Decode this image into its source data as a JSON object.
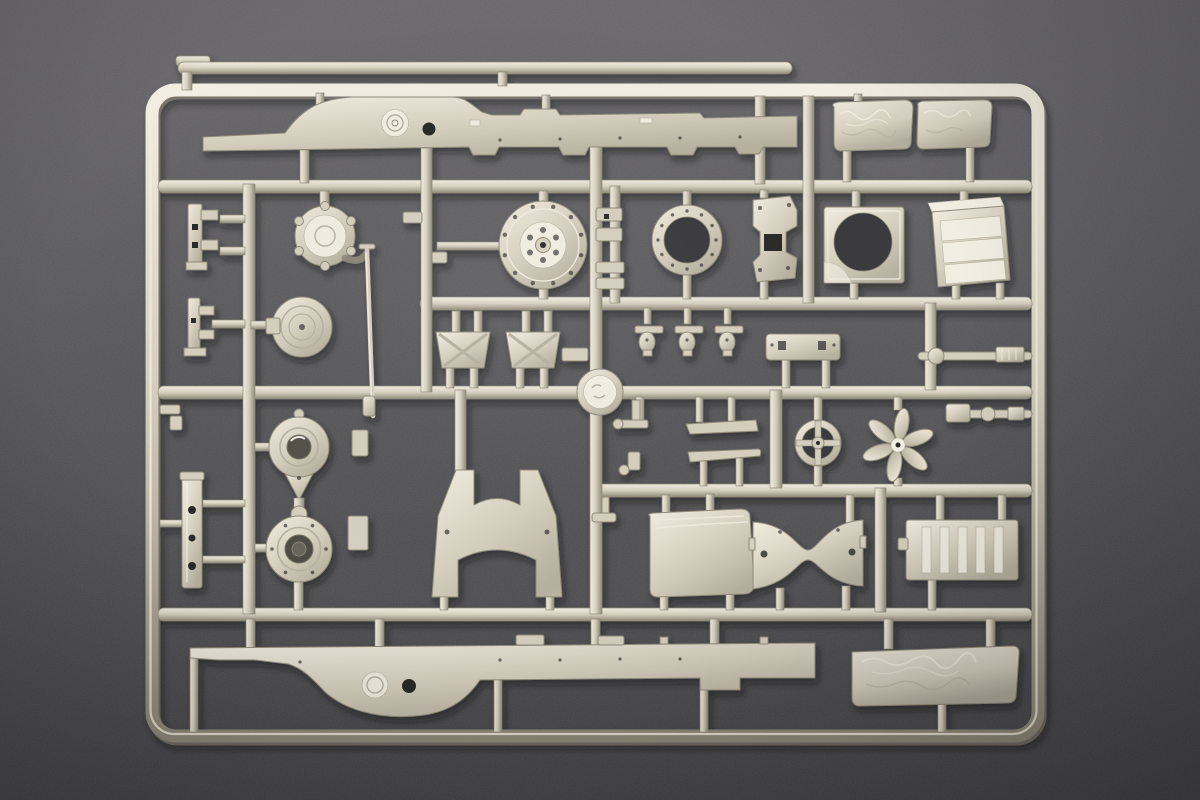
{
  "scene": {
    "type": "photograph",
    "subject": "Injection-moulded plastic model-kit sprue (parts tree) of light grey-beige styrene lying on a dark grey textured surface",
    "lighting": "soft light from upper left, parts cast small soft shadows",
    "text_visible": "none"
  },
  "colors": {
    "bg_top": "#615f63",
    "bg_mid": "#4c4b4e",
    "bg_bottom": "#39383b",
    "bg_hole": "#3b3a3d",
    "plastic_light": "#f2eee1",
    "plastic_base": "#d6d0bf",
    "plastic_mid": "#b7b1a0",
    "plastic_dark": "#918b7b",
    "hole_dark": "#2b2a28",
    "canvas_light": "#ece8dc",
    "canvas_shade": "#b3ad9d"
  },
  "sprue": {
    "frame": "rectangular outer runner frame with rounded corners, five internal horizontal runners and many vertical feed runners",
    "parts": [
      {
        "name": "top-runner-bar",
        "desc": "spare thin runner bar above the top rail"
      },
      {
        "name": "chassis-rail-top",
        "desc": "long ladder-chassis side rail with raised hump, round boss and open hole"
      },
      {
        "name": "canvas-tilt-left",
        "desc": "crumpled canvas tilt block"
      },
      {
        "name": "canvas-tilt-right",
        "desc": "crumpled canvas tilt block"
      },
      {
        "name": "filler-pot",
        "desc": "round filler pot with spout"
      },
      {
        "name": "torsion-rod",
        "desc": "long thin rod with collar"
      },
      {
        "name": "pot-lid",
        "desc": "round lid with concentric rings"
      },
      {
        "name": "axle-gear-disc",
        "desc": "large bolted hub disc with centre bore"
      },
      {
        "name": "turret-ring",
        "desc": "large open bolt ring"
      },
      {
        "name": "cab-bracket",
        "desc": "angled bracket plate with square opening"
      },
      {
        "name": "hatch-frame",
        "desc": "square frame with large round opening"
      },
      {
        "name": "radiator-box",
        "desc": "louvred radiator box seen in perspective"
      },
      {
        "name": "spring-clip-a",
        "desc": "small stepped clip on left edge"
      },
      {
        "name": "spring-clip-b",
        "desc": "small stepped clip on left edge"
      },
      {
        "name": "clip-pair",
        "desc": "two small clips beside centre runner"
      },
      {
        "name": "x-brace-panel-left",
        "desc": "trapezoid panel with X bracing"
      },
      {
        "name": "x-brace-panel-right",
        "desc": "trapezoid panel with X bracing"
      },
      {
        "name": "pipe-fittings",
        "desc": "three small pipe fittings in a row"
      },
      {
        "name": "hinge-bar",
        "desc": "bolted hinge bar with legs"
      },
      {
        "name": "prop-shaft",
        "desc": "propeller shaft with collar and knurled end"
      },
      {
        "name": "drag-link",
        "desc": "stepped drag-link rod"
      },
      {
        "name": "sprue-hub",
        "desc": "round moulding hub at runner crossing"
      },
      {
        "name": "axle-housing-upper",
        "desc": "teardrop axle housing with open bore"
      },
      {
        "name": "axle-housing-lower",
        "desc": "teardrop axle housing with cap"
      },
      {
        "name": "side-plate",
        "desc": "narrow vertical plate with three holes"
      },
      {
        "name": "yoke-crossmember",
        "desc": "U-shaped chassis yoke with two legs"
      },
      {
        "name": "bench-bars",
        "desc": "two slim bench bars with small valves"
      },
      {
        "name": "steering-wheel",
        "desc": "four-spoke steering wheel"
      },
      {
        "name": "engine-fan",
        "desc": "six-blade engine fan"
      },
      {
        "name": "seat-panel",
        "desc": "rounded seat base panel"
      },
      {
        "name": "bowtie-crossmember",
        "desc": "waisted cross-member plate with holes"
      },
      {
        "name": "slat-door",
        "desc": "slatted locker door panel"
      },
      {
        "name": "chassis-rail-bottom",
        "desc": "mirrored chassis side rail with downward hump, boss and hole"
      },
      {
        "name": "canvas-tilt-bottom",
        "desc": "long crumpled canvas tilt block"
      }
    ]
  }
}
